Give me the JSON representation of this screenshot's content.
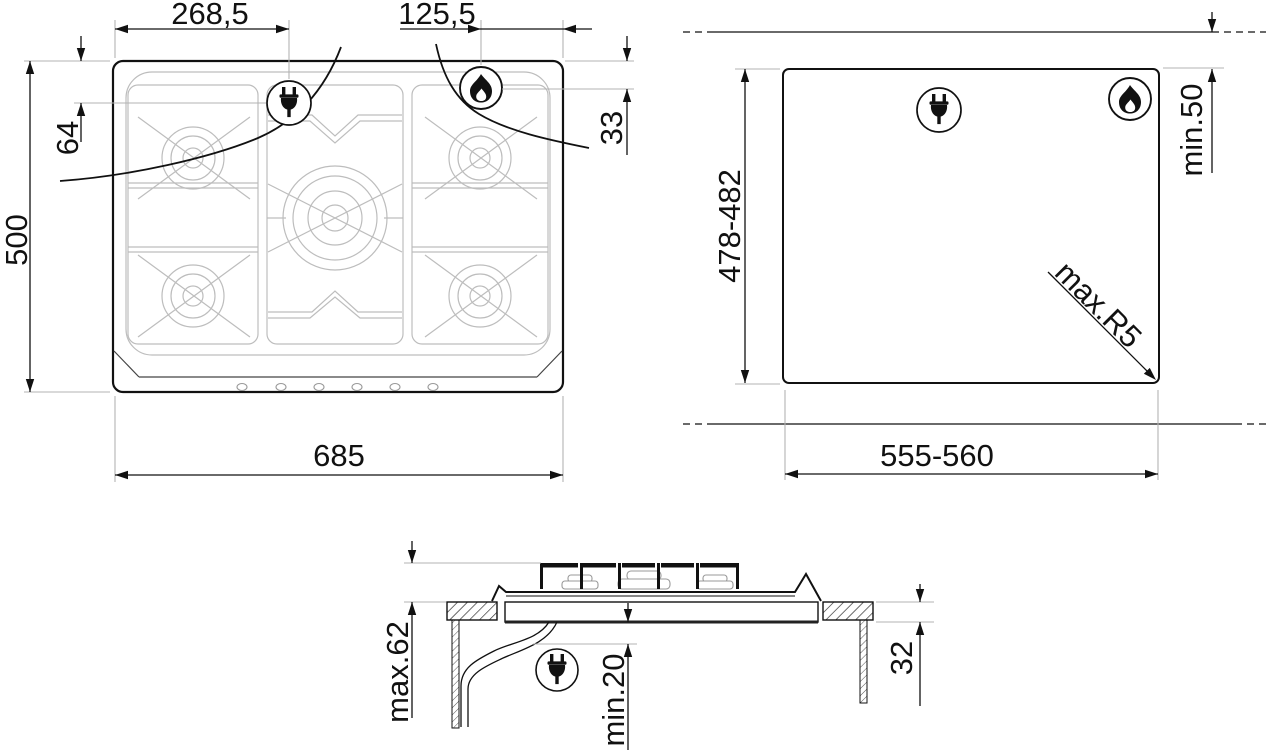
{
  "title": "Gas hob installation dimensions drawing",
  "views": {
    "top": {
      "label": "hob-top-view",
      "dim_plug_x": "268,5",
      "dim_flame_x": "125,5",
      "dim_plug_y": "64",
      "dim_depth": "500",
      "dim_flame_y": "33",
      "dim_width": "685"
    },
    "cutout": {
      "label": "worktop-cutout-view",
      "dim_depth": "478-482",
      "dim_wall_clearance": "min.50",
      "dim_corner_radius": "max.R5",
      "dim_width": "555-560"
    },
    "side": {
      "label": "side-section-view",
      "dim_height_above": "max.62",
      "dim_clearance_below": "min.20",
      "dim_depth_below": "32"
    }
  },
  "icons": {
    "plug": "power-plug-icon",
    "flame": "gas-flame-icon"
  },
  "colors": {
    "line": "#111111",
    "extension": "#b3b3b3",
    "detail": "#bdbdbd",
    "background": "#ffffff"
  }
}
